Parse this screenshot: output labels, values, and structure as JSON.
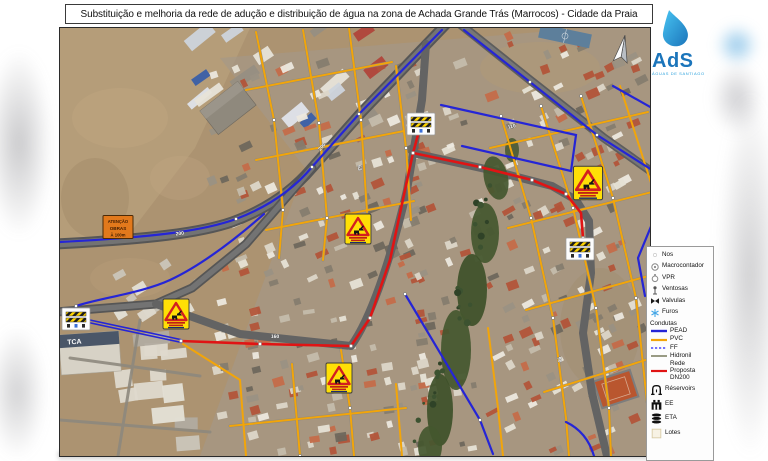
{
  "title": "Substituição e melhoria da rede de adução e distribuição de água na zona de Achada Grande Trás (Marrocos) - Cidade da Praia",
  "logo": {
    "acronym": "AdS",
    "subtitle": "ÁGUAS DE SANTIAGO"
  },
  "legend": {
    "points": [
      {
        "label": "Nos"
      },
      {
        "label": "Macrocontador"
      },
      {
        "label": "VPR"
      },
      {
        "label": "Ventosas"
      },
      {
        "label": "Valvulas"
      },
      {
        "label": "Furos"
      }
    ],
    "section": "Condutas",
    "lines": [
      {
        "label": "PEAD",
        "color": "#2525d6"
      },
      {
        "label": "PVC",
        "color": "#f2a50a"
      },
      {
        "label": "FF",
        "color": "#4646ff"
      },
      {
        "label": "Hidronil",
        "color": "#8e9077"
      },
      {
        "label": "Rede Proposta DN200",
        "color": "#e01414"
      }
    ],
    "facilities": [
      {
        "label": "Réservoirs"
      },
      {
        "label": "EE"
      },
      {
        "label": "ETA"
      },
      {
        "label": "Lotes"
      }
    ]
  },
  "map": {
    "attention_sign": {
      "line1": "ATENÇÃO",
      "line2": "OBRAS",
      "line3": "À 100m"
    },
    "building_label": "TCA",
    "pipe_labels": [
      {
        "t": "200"
      },
      {
        "t": "200"
      },
      {
        "t": "160"
      },
      {
        "t": "110"
      },
      {
        "t": "90"
      },
      {
        "t": "63"
      }
    ]
  },
  "colors": {
    "pead": "#2525d6",
    "pvc": "#f2a50a",
    "proposed": "#e01414",
    "ff": "#4646ff",
    "hidronil": "#8e9077"
  }
}
